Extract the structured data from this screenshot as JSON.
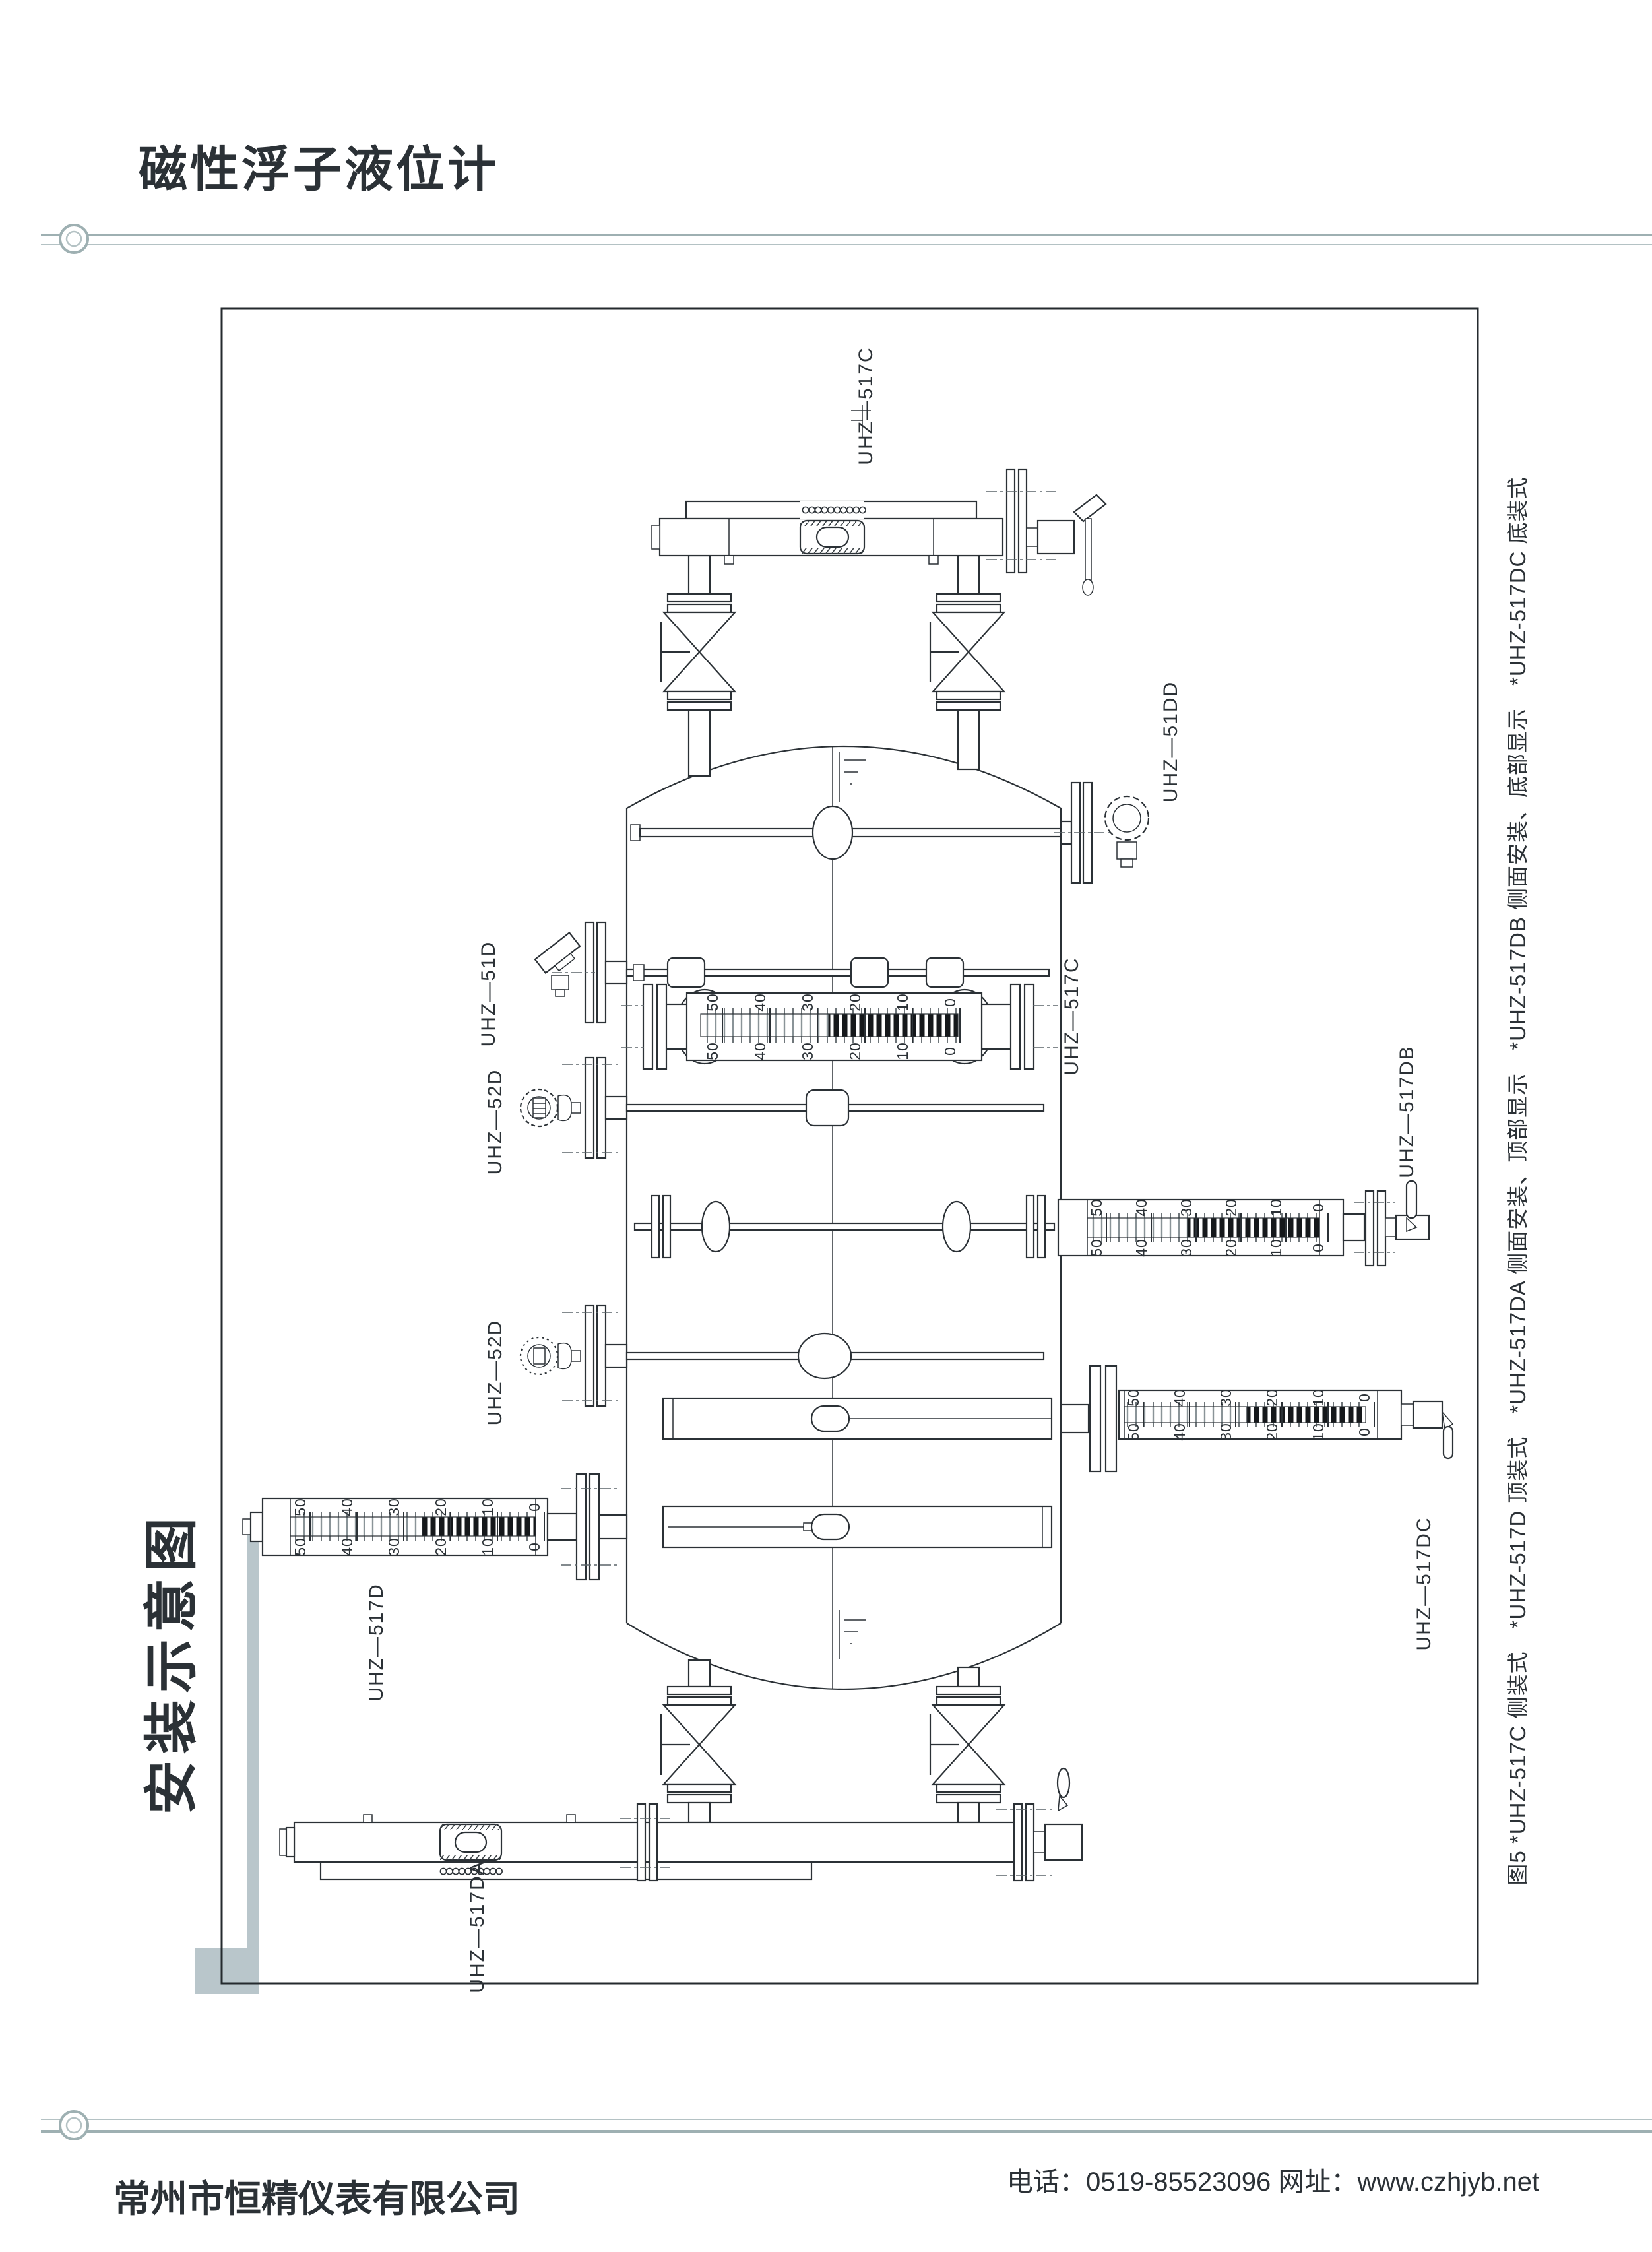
{
  "page": {
    "header_title": "磁性浮子液位计",
    "sidebar_title": "安装示意图"
  },
  "diagram": {
    "caption": "图5  *UHZ-517C 侧装式　*UHZ-517D 顶装式　*UHZ-517DA 侧面安装、顶部显示　*UHZ-517DB 侧面安装、底部显示　*UHZ-517DC 底装式",
    "scale_numbers": [
      "50",
      "40",
      "30",
      "20",
      "10",
      "0"
    ],
    "labels": {
      "top_517c": "UHZ—517C",
      "side_51dd": "UHZ—51DD",
      "side_51d": "UHZ—51D",
      "mid_517c": "UHZ—517C",
      "side_52d_1": "UHZ—52D",
      "side_517db": "UHZ—517DB",
      "side_52d_2": "UHZ—52D",
      "side_517dc": "UHZ—517DC",
      "side_517d": "UHZ—517D",
      "bottom_517da": "UHZ—517DA"
    },
    "colors": {
      "line": "#2b3136",
      "title": "#7a8a8a",
      "rule": "#a3b4b6",
      "accent_bar": "#b9c6cb"
    }
  },
  "footer": {
    "company": "常州市恒精仪表有限公司",
    "contact": "电话：0519-85523096  网址：www.czhjyb.net"
  }
}
